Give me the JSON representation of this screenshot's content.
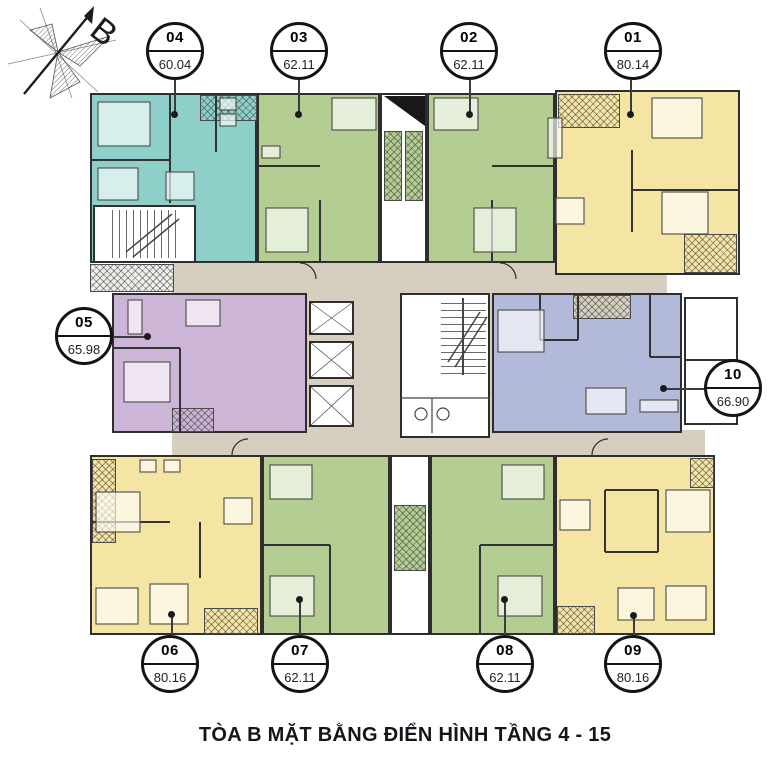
{
  "title": "TÒA B MẶT BẰNG ĐIỂN HÌNH TẦNG 4 - 15",
  "compass": {
    "label": "B"
  },
  "units": [
    {
      "id": "01",
      "area": "80.14",
      "color": "#f5e5a4"
    },
    {
      "id": "02",
      "area": "62.11",
      "color": "#b3cd92"
    },
    {
      "id": "03",
      "area": "62.11",
      "color": "#b3cd92"
    },
    {
      "id": "04",
      "area": "60.04",
      "color": "#8ed0c9"
    },
    {
      "id": "05",
      "area": "65.98",
      "color": "#cdb5d8"
    },
    {
      "id": "06",
      "area": "80.16",
      "color": "#f5e5a4"
    },
    {
      "id": "07",
      "area": "62.11",
      "color": "#b3cd92"
    },
    {
      "id": "08",
      "area": "62.11",
      "color": "#b3cd92"
    },
    {
      "id": "09",
      "area": "80.16",
      "color": "#f5e5a4"
    },
    {
      "id": "10",
      "area": "66.90",
      "color": "#b2b9d9"
    }
  ],
  "colors": {
    "corridor": "#d6cfc0",
    "wall": "#2e2e2e",
    "background": "#ffffff",
    "balcony_gray": "#f0efec",
    "title_text": "#14141c"
  }
}
